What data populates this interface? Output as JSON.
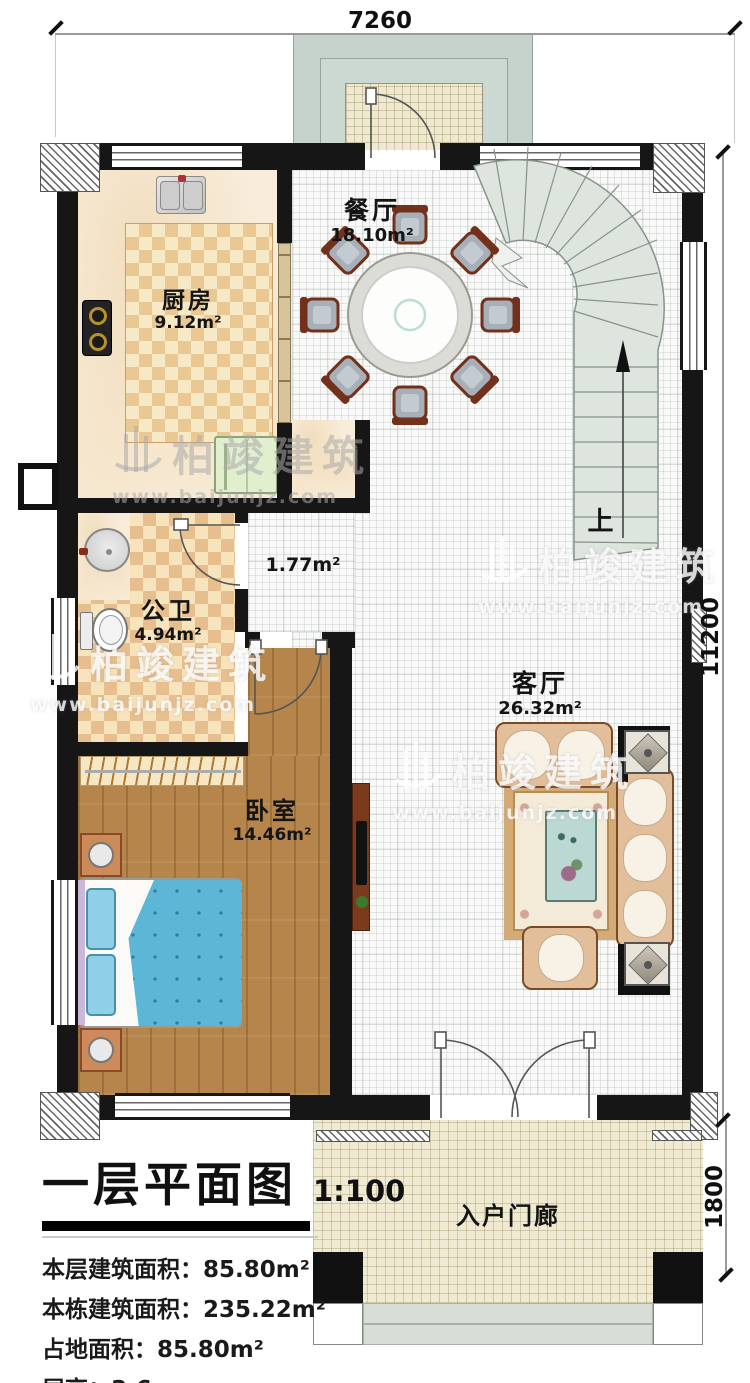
{
  "plan": {
    "dimensions": {
      "top": "7260",
      "right": "11200",
      "porch": "1800"
    },
    "stairs_up_label": "上",
    "rooms": {
      "dining": {
        "name": "餐厅",
        "area": "18.10m²"
      },
      "kitchen": {
        "name": "厨房",
        "area": "9.12m²"
      },
      "bath": {
        "name": "公卫",
        "area": "4.94m²"
      },
      "hall": {
        "area": "1.77m²"
      },
      "bedroom": {
        "name": "卧室",
        "area": "14.46m²"
      },
      "living": {
        "name": "客厅",
        "area": "26.32m²"
      },
      "porch": {
        "name": "入户门廊"
      }
    }
  },
  "watermark": {
    "brand": "柏竣建筑",
    "url": "www.baijunjz.com"
  },
  "title_block": {
    "title": "一层平面图",
    "scale": "1:100",
    "stats": [
      {
        "label": "本层建筑面积：",
        "value": "85.80m²"
      },
      {
        "label": "本栋建筑面积：",
        "value": "235.22m²"
      },
      {
        "label": "占地面积：",
        "value": "85.80m²"
      },
      {
        "label": "层高：",
        "value": "3.6m"
      }
    ]
  }
}
